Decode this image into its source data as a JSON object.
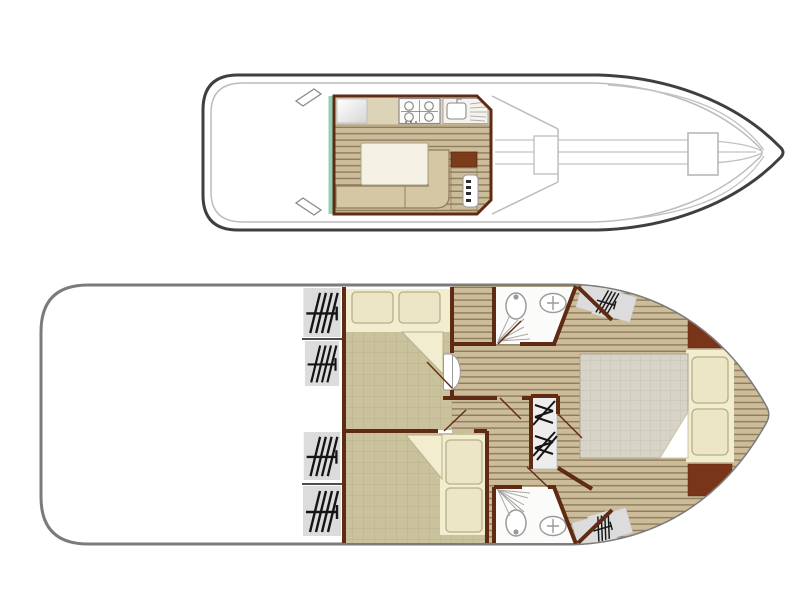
{
  "diagram": {
    "type": "boat-floor-plan",
    "views": [
      {
        "id": "upper-deck",
        "name": "exterior top view with saloon cutaway"
      },
      {
        "id": "lower-deck",
        "name": "lower deck cabin plan"
      }
    ],
    "rooms": [
      "aft-deck",
      "saloon-galley",
      "foredeck",
      "cabin-aft-top",
      "cabin-aft-bottom",
      "bathroom-top",
      "bathroom-bottom",
      "corridor",
      "bow-cabin"
    ],
    "icons": [
      "window-blind-icon",
      "stove-icon",
      "sink-icon",
      "fridge-icon",
      "toilet-icon",
      "washbasin-icon",
      "shower-spray-icon",
      "stairs-icon",
      "steps-icon",
      "bed-icon",
      "pillow-icon",
      "table-icon",
      "bench-icon",
      "helm-console-icon",
      "cleat-icon",
      "deck-hatch-icon"
    ]
  },
  "colors": {
    "hull_outline_top": "#3f3f3f",
    "hull_inner_top": "#bcbcbc",
    "hull_outline_bottom": "#7b7b7b",
    "wall": "#5f2c13",
    "wood_light": "#ccbc9a",
    "wood_gap": "#8e7d5d",
    "carpet": "#c9c29c",
    "carpet_grid": "#b9b188",
    "bed_sheet": "#f2edcf",
    "pillow": "#ece6c6",
    "pillow_edge": "#b6ae8c",
    "mattress": "#d7d3c7",
    "mattress_grid": "#c6c2b3",
    "mattress_edge": "#a9a496",
    "counter": "#ddd3b6",
    "bench": "#d6c7a4",
    "bench_edge": "#8c7c57",
    "table": "#f4f1e4",
    "table_edge": "#a9a28c",
    "teal": "#8fd1b5",
    "cabinet": "#7c3c1c",
    "headboard": "#7a341a",
    "bathroom_floor": "#fbfbf9",
    "fixture_edge": "#9a9a9a",
    "window_fill": "#dcdcdc",
    "hatch_black": "#141414",
    "stairs_fill": "#ededed",
    "deck_line": "#c2c2c2",
    "white": "#ffffff"
  }
}
